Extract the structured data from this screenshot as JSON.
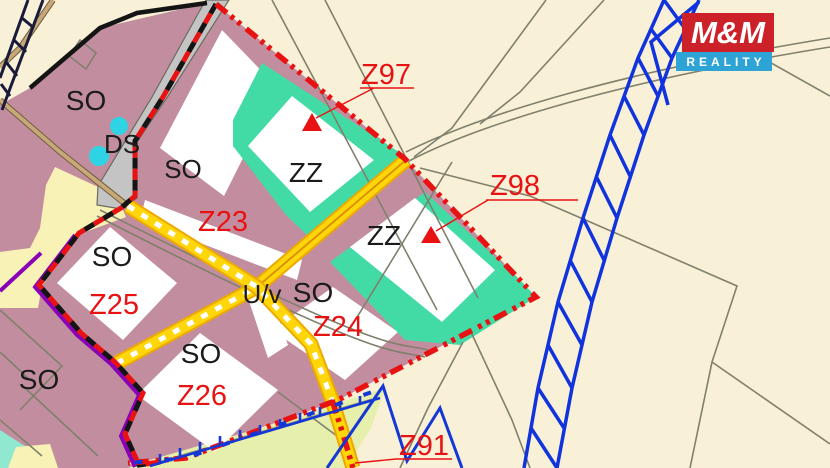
{
  "logo": {
    "brand": "M&M",
    "tagline": "REALITY"
  },
  "labels": [
    {
      "id": "so-topleft",
      "text": "SO"
    },
    {
      "id": "ds-road",
      "text": "DS"
    },
    {
      "id": "so-upper",
      "text": "SO"
    },
    {
      "id": "zz-upper",
      "text": "ZZ"
    },
    {
      "id": "zz-lower",
      "text": "ZZ"
    },
    {
      "id": "so-z25",
      "text": "SO"
    },
    {
      "id": "z25",
      "text": "Z25"
    },
    {
      "id": "z23",
      "text": "Z23"
    },
    {
      "id": "uv",
      "text": "U/v"
    },
    {
      "id": "so-center",
      "text": "SO"
    },
    {
      "id": "z24",
      "text": "Z24"
    },
    {
      "id": "so-z26",
      "text": "SO"
    },
    {
      "id": "z26",
      "text": "Z26"
    },
    {
      "id": "so-bottomleft",
      "text": "SO"
    },
    {
      "id": "z97",
      "text": "Z97"
    },
    {
      "id": "z98",
      "text": "Z98"
    },
    {
      "id": "z91",
      "text": "Z91"
    }
  ],
  "colors": {
    "cream_bg": "#f8f1d8",
    "mauve_zone": "#c28e9f",
    "teal_zone": "#42dba6",
    "white_plot": "#ffffff",
    "pale_yellow_zone": "#f9f2b6",
    "green_zone": "#e6efab",
    "road_yellow": "#ffd60a",
    "road_orange": "#eda900",
    "road_gray": "#c4c4c4",
    "road_tan": "#c8a878",
    "boundary_red": "#e81212",
    "boundary_purple": "#8a00b8",
    "water_blue": "#1437d6",
    "cyan_dot": "#2fd4e4",
    "parcel_gray": "#80806c",
    "logo_red": "#cc2128",
    "logo_blue": "#2ea3d6"
  }
}
